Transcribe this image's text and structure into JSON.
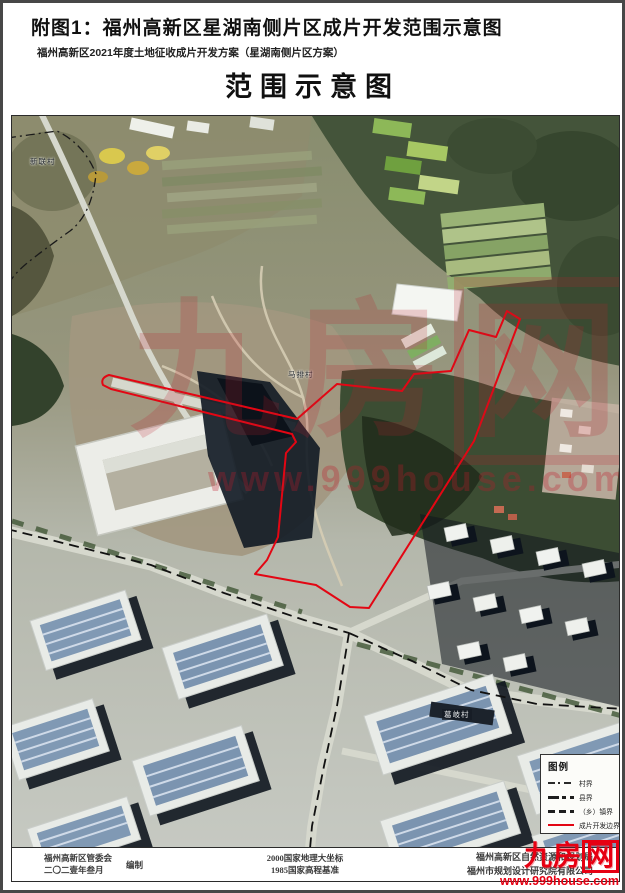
{
  "page": {
    "title": "附图1：福州高新区星湖南侧片区成片开发范围示意图",
    "subtitle": "福州高新区2021年度土地征收成片开发方案（星湖南侧片区方案）",
    "map_title": "范围示意图"
  },
  "map": {
    "village_labels": [
      {
        "text": "新联村"
      },
      {
        "text": "马排村"
      },
      {
        "text": "葛岐村"
      }
    ]
  },
  "legend": {
    "title": "图例",
    "items": [
      {
        "label": "村界",
        "style": "dash-dot-thin"
      },
      {
        "label": "县界",
        "style": "dash-thick"
      },
      {
        "label": "（乡）镇界",
        "style": "dash-bold"
      },
      {
        "label": "成片开发边界",
        "style": "solid-red"
      }
    ]
  },
  "footer": {
    "left_line1": "福州高新区管委会",
    "left_line2": "二〇二壹年叁月",
    "left_role": "编制",
    "center_line1": "2000国家地理大坐标",
    "center_line2": "1985国家高程基准",
    "right_line1": "福州高新区自然资源和规划局",
    "right_line2": "福州市规划设计研究院有限公司"
  },
  "watermark": {
    "text_main": "九房",
    "text_box": "网",
    "url": "www.999house.com",
    "color": "#e60012"
  },
  "colors": {
    "development_boundary": "#e30613",
    "boundary_black": "#1a1a1a"
  }
}
